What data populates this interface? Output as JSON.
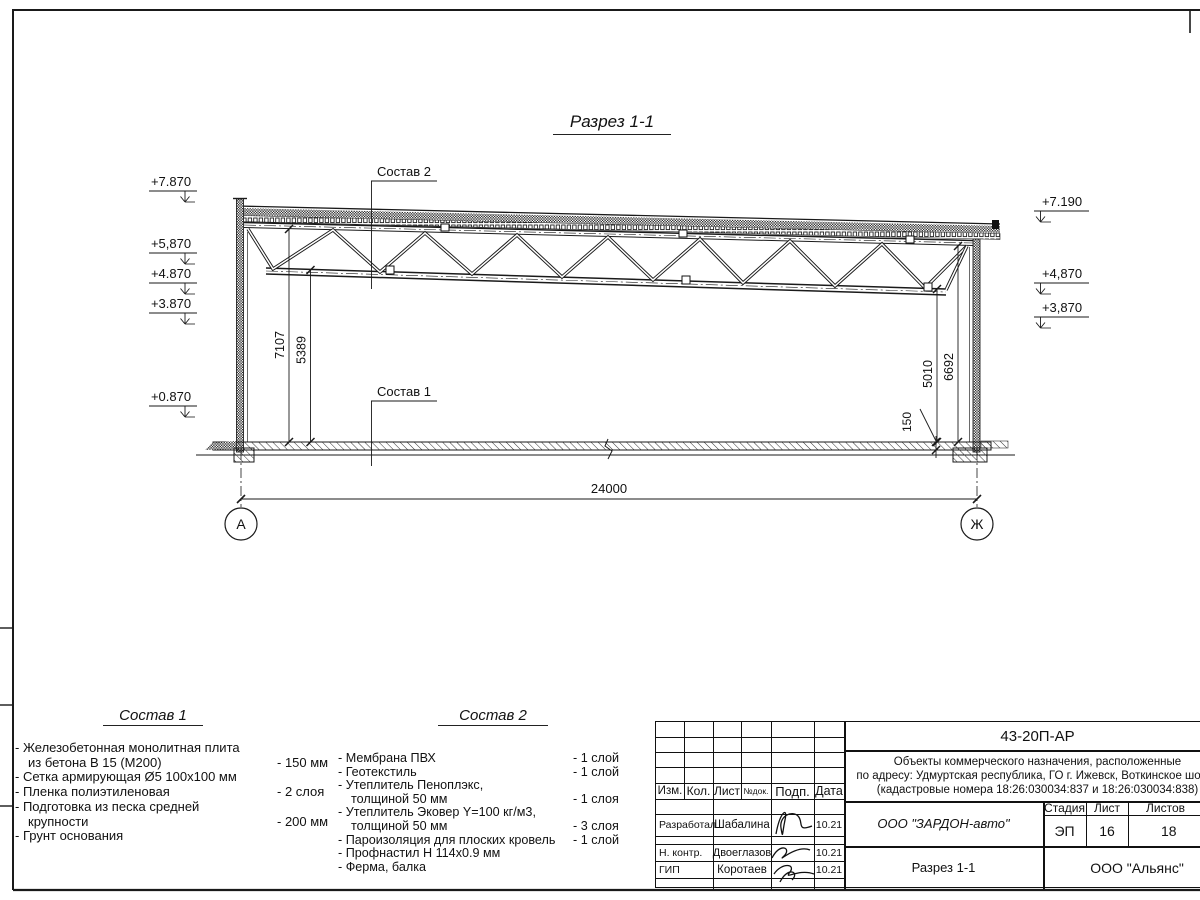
{
  "drawing": {
    "title": "Разрез 1-1",
    "label_sostav1": "Состав 1",
    "label_sostav2": "Состав 2",
    "elev_left": [
      "+7.870",
      "+5,870",
      "+4.870",
      "+3.870",
      "+0.870"
    ],
    "elev_right": [
      "+7.190",
      "+4,870",
      "+3,870"
    ],
    "dim_span": "24000",
    "dim_left_total": "7107",
    "dim_left_truss": "5389",
    "dim_right_truss": "5010",
    "dim_right_total": "6692",
    "dim_slab": "150",
    "axis_left": "А",
    "axis_right": "Ж"
  },
  "sostav1": {
    "heading": "Состав 1",
    "rows": [
      {
        "t": "- Железобетонная  монолитная плита",
        "v": ""
      },
      {
        "t": "из бетона В 15 (М200)",
        "v": "- 150 мм"
      },
      {
        "t": "- Сетка армирующая Ø5 100х100 мм",
        "v": ""
      },
      {
        "t": "- Пленка полиэтиленовая",
        "v": "-  2 слоя"
      },
      {
        "t": "- Подготовка из песка средней",
        "v": ""
      },
      {
        "t": "крупности",
        "v": "- 200 мм"
      },
      {
        "t": "- Грунт основания",
        "v": ""
      }
    ]
  },
  "sostav2": {
    "heading": "Состав 2",
    "rows": [
      {
        "t": "- Мембрана ПВХ",
        "v": "- 1 слой"
      },
      {
        "t": "- Геотекстиль",
        "v": "- 1 слой"
      },
      {
        "t": "- Утеплитель Пеноплэкс,",
        "v": ""
      },
      {
        "t": "толщиной 50 мм",
        "v": "- 1 слоя"
      },
      {
        "t": "- Утеплитель Эковер Y=100 кг/м3,",
        "v": ""
      },
      {
        "t": "толщиной 50 мм",
        "v": "- 3 слоя"
      },
      {
        "t": "- Пароизоляция для плоских кровель",
        "v": "- 1 слой"
      },
      {
        "t": "- Профнастил Н 114х0.9 мм",
        "v": ""
      },
      {
        "t": "- Ферма, балка",
        "v": ""
      }
    ]
  },
  "titleblock": {
    "doc_number": "43-20П-АР",
    "project_line1": "Объекты коммерческого назначения, расположенные",
    "project_line2": "по адресу: Удмуртская республика, ГО г. Ижевск, Воткинское шоссе",
    "project_line3": "(кадастровые номера 18:26:030034:837 и 18:26:030034:838)",
    "col_izm": "Изм.",
    "col_kol": "Кол.",
    "col_list": "Лист",
    "col_ndok": "№док.",
    "col_podp": "Подп.",
    "col_data": "Дата",
    "row1_role": "Разработал",
    "row1_name": "Шабалина",
    "row1_date": "10.21",
    "row2_role": "Н. контр.",
    "row2_name": "Двоеглазов",
    "row2_date": "10.21",
    "row3_role": "ГИП",
    "row3_name": "Коротаев",
    "row3_date": "10.21",
    "company": "ООО \"ЗАРДОН-авто\"",
    "stage_label": "Стадия",
    "sheet_label": "Лист",
    "sheets_label": "Листов",
    "stage": "ЭП",
    "sheet": "16",
    "sheets": "18",
    "sheet_title": "Разрез 1-1",
    "contractor": "ООО \"Альянс\""
  }
}
